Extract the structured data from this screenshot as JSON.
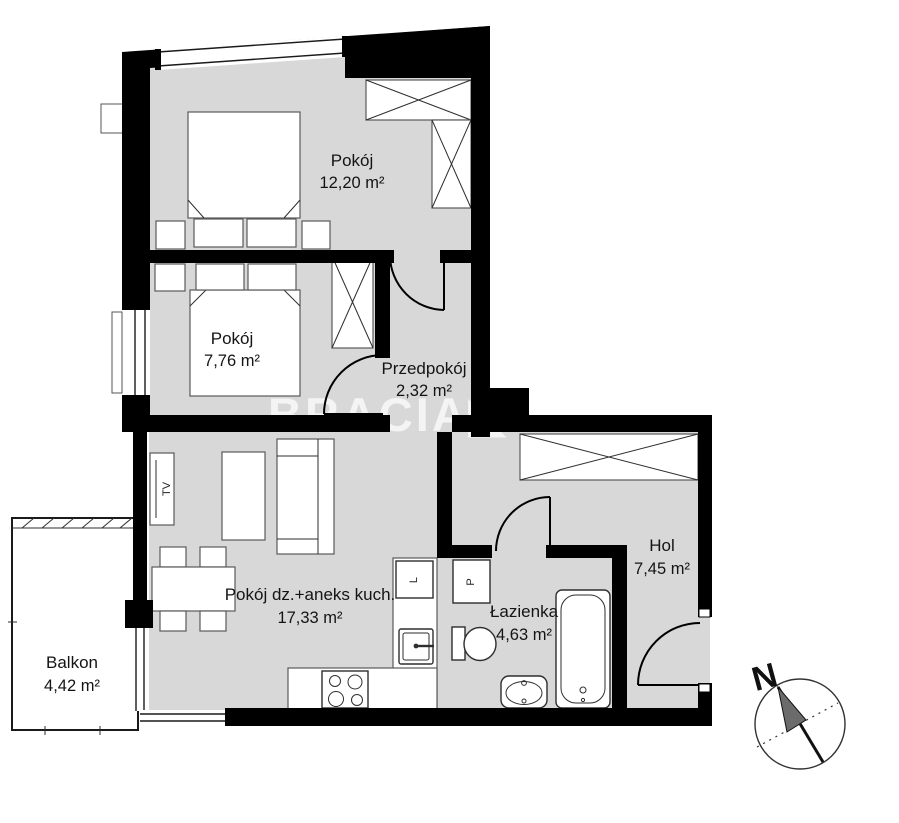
{
  "plan": {
    "watermark": "BRACIA◣ SA",
    "floor_color": "#d8d8d8",
    "wall_color": "#000000",
    "rooms": [
      {
        "id": "pokoj-1",
        "name": "Pokój",
        "area": "12,20 m²"
      },
      {
        "id": "pokoj-2",
        "name": "Pokój",
        "area": "7,76 m²"
      },
      {
        "id": "przedpokoj",
        "name": "Przedpokój",
        "area": "2,32 m²"
      },
      {
        "id": "salon",
        "name": "Pokój dz.+aneks kuch.",
        "area": "17,33 m²"
      },
      {
        "id": "lazienka",
        "name": "Łazienka",
        "area": "4,63 m²"
      },
      {
        "id": "hol",
        "name": "Hol",
        "area": "7,45 m²"
      },
      {
        "id": "balkon",
        "name": "Balkon",
        "area": "4,42 m²"
      }
    ],
    "appliances": {
      "tv": "TV",
      "fridge": "L",
      "washer": "P"
    },
    "compass": {
      "north_label": "N"
    }
  }
}
